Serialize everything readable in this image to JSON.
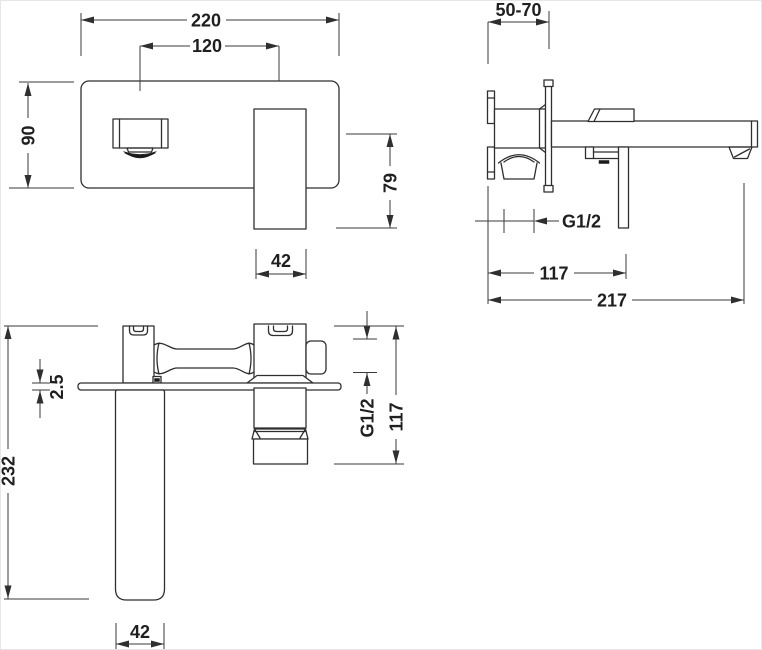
{
  "drawing_type": "faucet-technical-dimension-drawing",
  "colors": {
    "line": "#2f2f2f",
    "dimension_line": "#3a3a3a",
    "text": "#1f1f1f",
    "background": "#ffffff"
  },
  "views": {
    "front": {
      "dims": {
        "width": "220",
        "spout_to_handle": "120",
        "height": "90",
        "drop_to_handle_end": "79",
        "handle_width": "42"
      }
    },
    "side": {
      "dims": {
        "wall_depth_range": "50-70",
        "thread": "G1/2",
        "handle_reach": "117",
        "spout_reach": "217"
      }
    },
    "plan": {
      "dims": {
        "plate_thickness": "2.5",
        "total_length": "232",
        "thread": "G1/2",
        "body_reach": "117",
        "spout_width": "42"
      }
    }
  }
}
